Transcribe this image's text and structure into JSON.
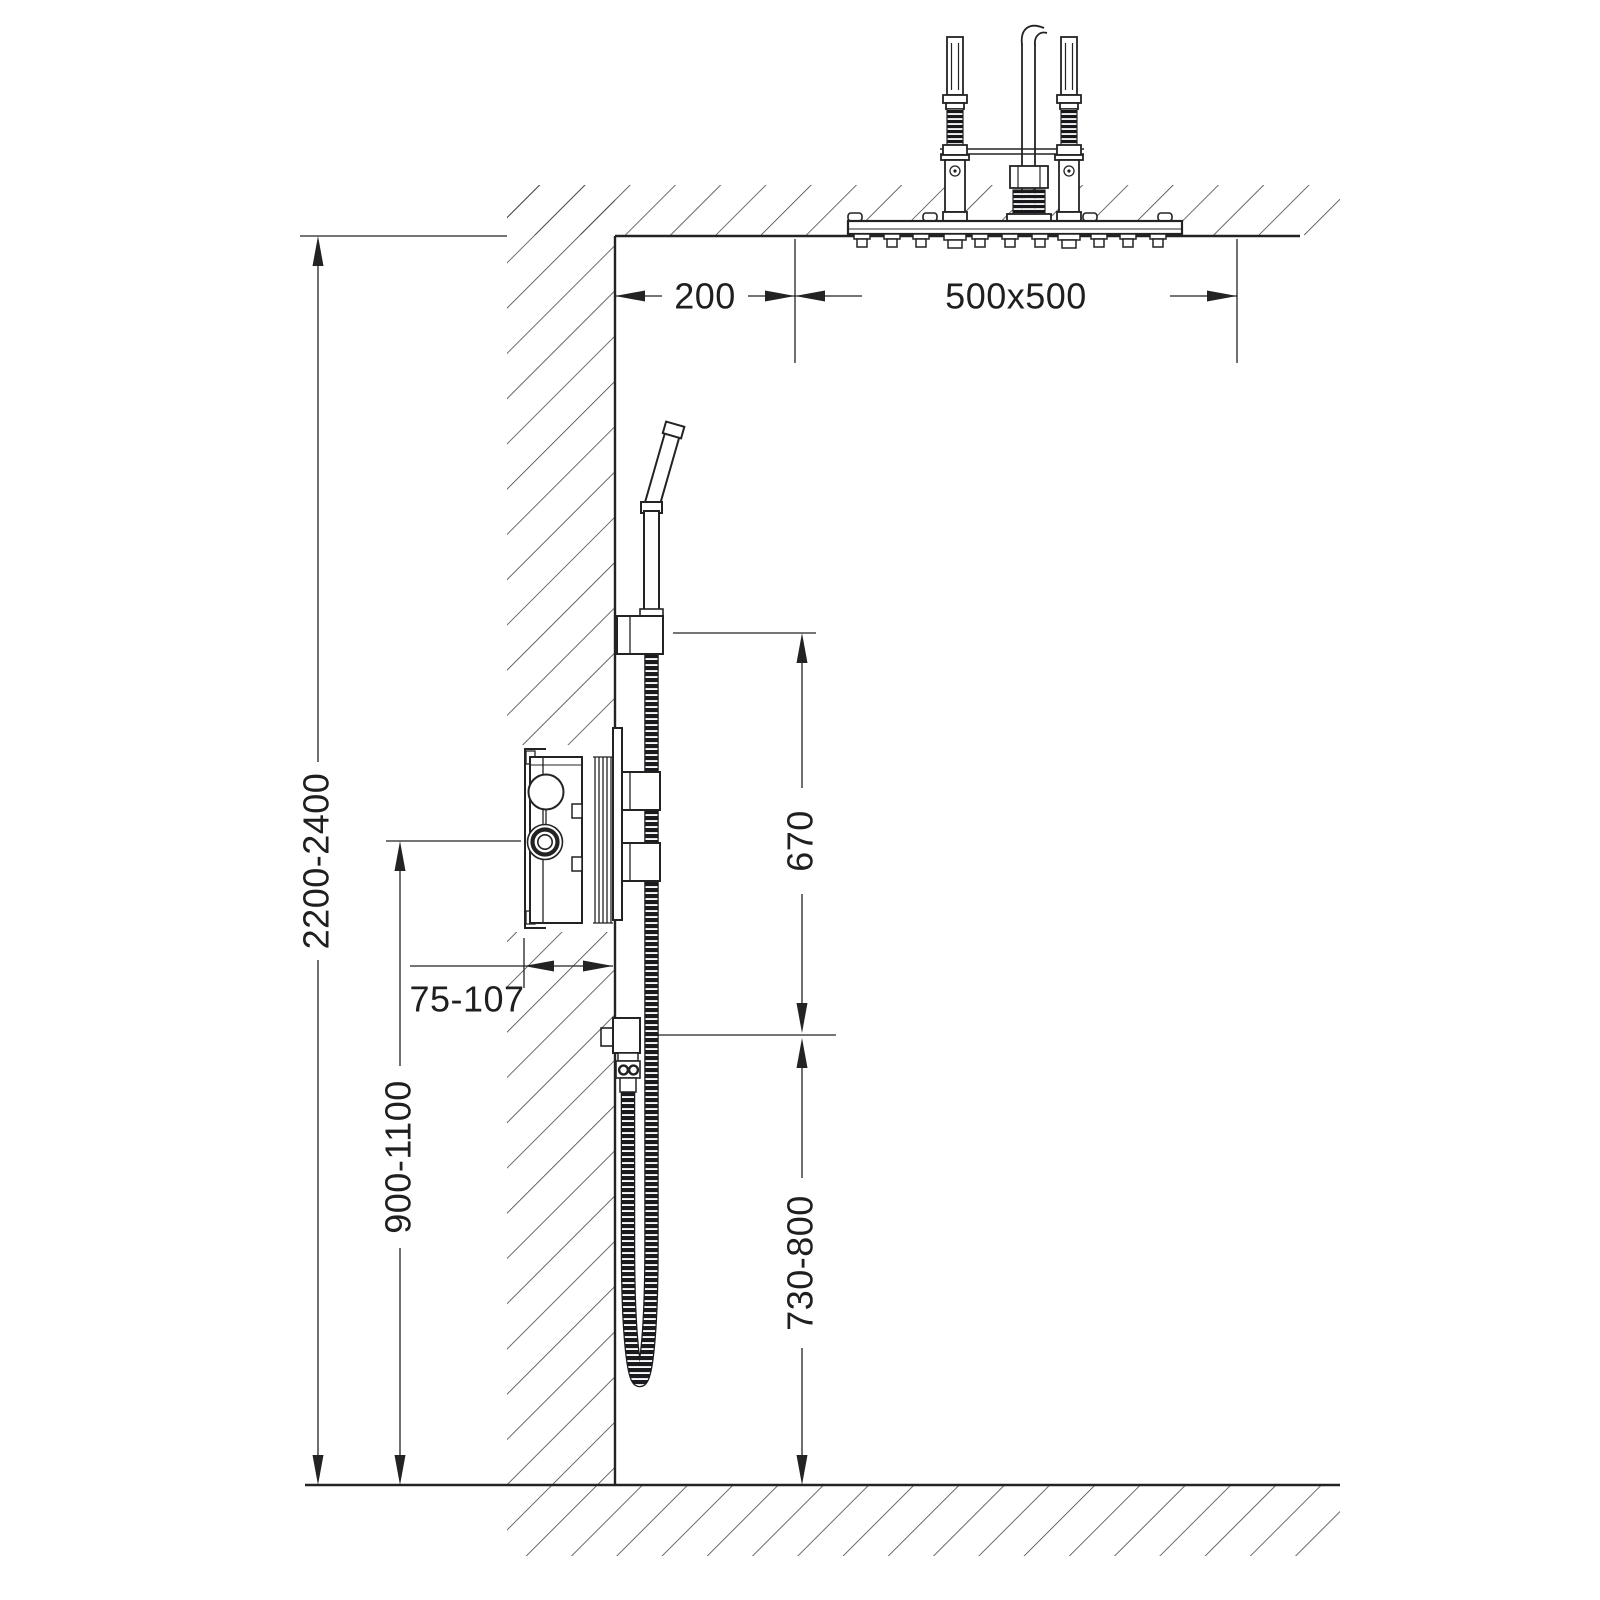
{
  "dims": {
    "wall_offset": "200",
    "head_size": "500x500",
    "room_height": "2200-2400",
    "valve_height": "900-1100",
    "valve_depth": "75-107",
    "holder_to_outlet": "670",
    "outlet_to_floor": "730-800"
  },
  "colors": {
    "ink": "#232323",
    "background": "#ffffff",
    "hose_dark": "#1b1b1f"
  }
}
